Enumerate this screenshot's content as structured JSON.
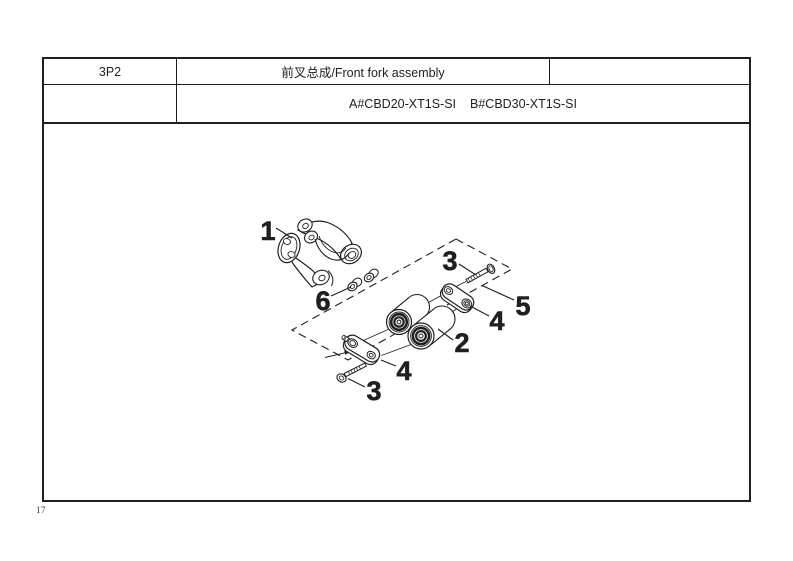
{
  "header": {
    "code": "3P2",
    "title": "前叉总成/Front fork assembly",
    "model_a": "A#CBD20-XT1S-SI",
    "model_b": "B#CBD30-XT1S-SI"
  },
  "footer": {
    "page_number": "17"
  },
  "diagram": {
    "type": "exploded-parts-diagram",
    "assembly": "Front fork assembly",
    "callouts": [
      {
        "label": "1"
      },
      {
        "label": "2"
      },
      {
        "label": "3"
      },
      {
        "label": "3"
      },
      {
        "label": "4"
      },
      {
        "label": "4"
      },
      {
        "label": "5"
      },
      {
        "label": "6"
      }
    ]
  },
  "colors": {
    "line": "#1f1f1f",
    "background": "#ffffff"
  }
}
